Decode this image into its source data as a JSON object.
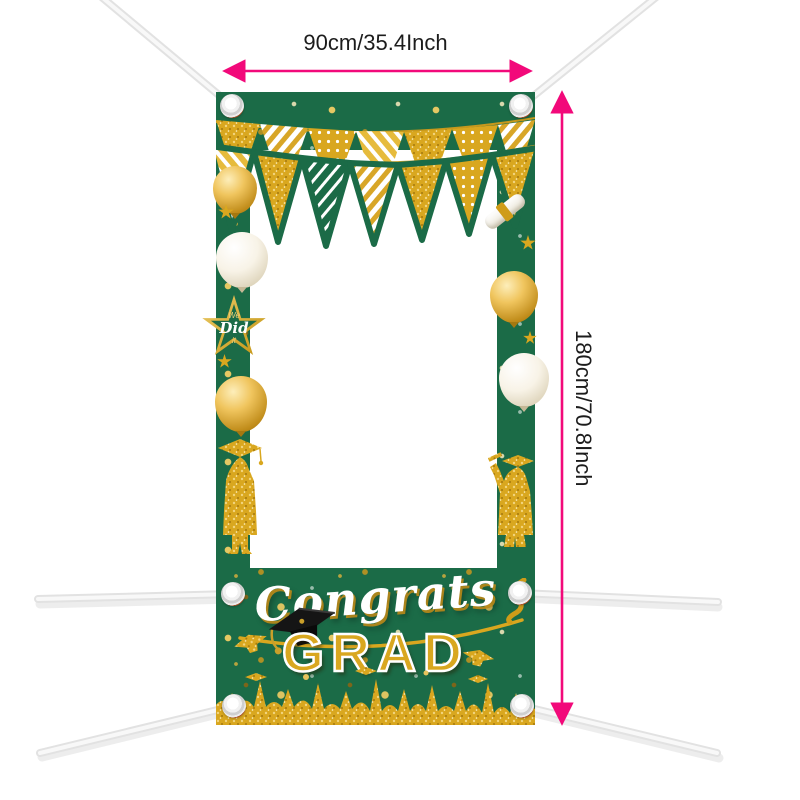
{
  "product_view": {
    "dimensions": {
      "width_label": "90cm/35.4Inch",
      "height_label": "180cm/70.8Inch"
    },
    "banner": {
      "congrats": "Congrats",
      "grad": "GRAD",
      "star_badge": {
        "top": "We",
        "middle": "Did",
        "bottom": "it"
      }
    },
    "colors": {
      "dimension_arrow": "#f2097a",
      "dimension_text": "#1c1c1c",
      "banner_green": "#1b6b47",
      "gold": "#d9a71f",
      "gold_deep": "#a5790d",
      "rope_white": "#ececec",
      "congrats_white": "#ffffff",
      "cap_black": "#151515"
    }
  }
}
